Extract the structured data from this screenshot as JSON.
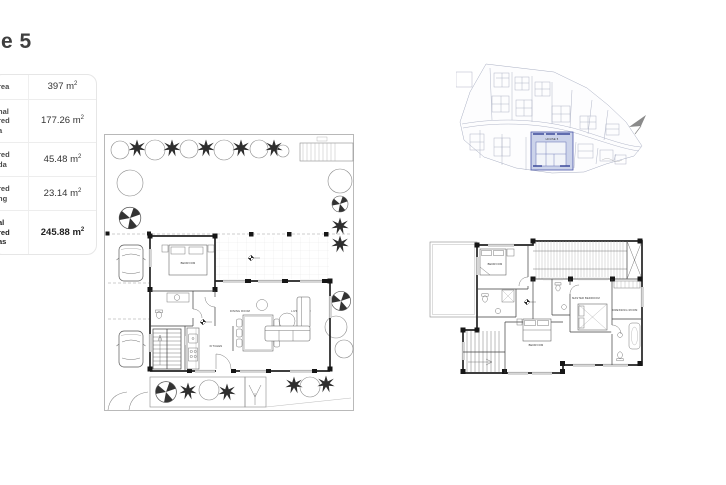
{
  "page": {
    "title_fragment": "e 5"
  },
  "area_table": {
    "rows": [
      {
        "label": "rea",
        "value": "397 m",
        "sup": "2"
      },
      {
        "label": "nal\nred\na",
        "value": "177.26 m",
        "sup": "2"
      },
      {
        "label": "red\nda",
        "value": "45.48 m",
        "sup": "2"
      },
      {
        "label": "red\nng",
        "value": "23.14 m",
        "sup": "2"
      },
      {
        "label": "al\nred\nas",
        "value": "245.88 m",
        "sup": "2"
      }
    ]
  },
  "site_plan": {
    "highlight_label": "HOUSE 5"
  },
  "ground_floor": {
    "labels": {
      "bedroom": "BEDROOM",
      "kitchen": "KITCHEN",
      "dining_room": "DINING ROOM",
      "living_room": "LIVING ROOM"
    }
  },
  "first_floor": {
    "labels": {
      "bedroom_top": "BEDROOM",
      "bedroom_bottom": "BEDROOM",
      "master_bedroom": "MASTER BEDROOM",
      "dressing_room": "DRESSING ROOM"
    }
  },
  "colors": {
    "highlight_fill": "#ccd3ea",
    "highlight_stroke": "#4a57a8",
    "plan_line": "#3a3a3a",
    "site_line": "#a8aec2"
  }
}
